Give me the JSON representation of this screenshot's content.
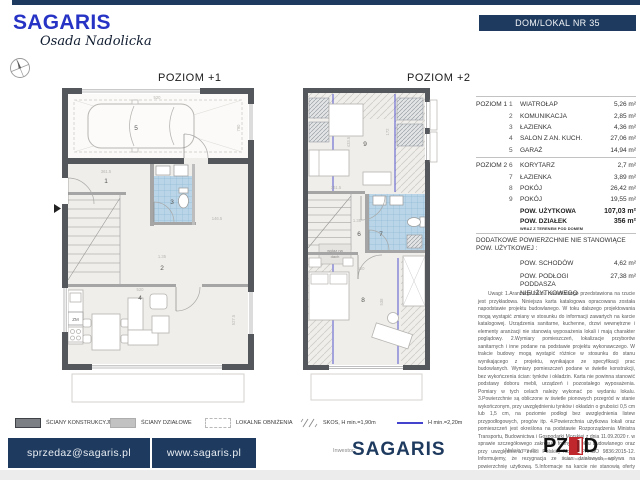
{
  "header": {
    "brand": "SAGARIS",
    "brand_sub": "Osada Nadolicka",
    "unit_label": "DOM/LOKAL NR 35"
  },
  "plans": {
    "level1": {
      "title": "POZIOM +1",
      "rooms": {
        "n1": "1",
        "n2": "2",
        "n3": "3",
        "n4": "4",
        "n5": "5"
      },
      "labels": {
        "dishwasher": "ZM"
      },
      "dims": {
        "garage_width": "520",
        "garage_depth": "790",
        "hall_width": "361.5",
        "corridor": "1.35",
        "niche": "146.5",
        "salon_width": "520",
        "salon_depth": "527.5"
      }
    },
    "level2": {
      "title": "POZIOM +2",
      "rooms": {
        "n6": "6",
        "n7": "7",
        "n8": "8",
        "n9": "9"
      },
      "labels": {
        "roof_hatch_line1": "wyłaz na",
        "roof_hatch_line2": "dach"
      },
      "dims": {
        "room9_depth": "433.5",
        "room9_width": "172",
        "hall_width": "361.5",
        "corridor": "1.35",
        "room8_width": "520",
        "room8_depth": "538"
      }
    }
  },
  "table": {
    "rows": [
      {
        "level": "POZIOM 1",
        "no": "1",
        "label": "WIATROŁAP",
        "area": "5,26 m²"
      },
      {
        "level": "",
        "no": "2",
        "label": "KOMUNIKACJA",
        "area": "2,85 m²"
      },
      {
        "level": "",
        "no": "3",
        "label": "ŁAZIENKA",
        "area": "4,36 m²"
      },
      {
        "level": "",
        "no": "4",
        "label": "SALON Z AN. KUCH.",
        "area": "27,06 m²"
      },
      {
        "level": "",
        "no": "5",
        "label": "GARAŻ",
        "area": "14,94 m²"
      },
      {
        "level": "POZIOM 2",
        "no": "6",
        "label": "KORYTARZ",
        "area": "2,7 m²"
      },
      {
        "level": "",
        "no": "7",
        "label": "ŁAZIENKA",
        "area": "3,89 m²"
      },
      {
        "level": "",
        "no": "8",
        "label": "POKÓJ",
        "area": "26,42 m²"
      },
      {
        "level": "",
        "no": "9",
        "label": "POKÓJ",
        "area": "19,55 m²"
      }
    ],
    "totals": [
      {
        "label": "POW. UŻYTKOWA",
        "sub": "",
        "value": "107,03 m²"
      },
      {
        "label": "POW. DZIAŁEK",
        "sub": "WRAZ Z TERENEM POD DOMEM",
        "value": "356 m²"
      }
    ],
    "additional_title": "DODATKOWE POWIERZCHNIE NIE STANOWIĄCE POW. UŻYTKOWEJ :",
    "additional": [
      {
        "label": "POW. SCHODÓW",
        "value": "4,62 m²"
      },
      {
        "label": "POW. PODŁOGI PODDASZA NIEUŻYTKOWEGO",
        "value": "27,38 m²"
      }
    ]
  },
  "notes": {
    "text": "Uwagi: 1.Aranżacja lokalu mieszkalnego przedstawiona na rzucie jest przykładowa. Niniejsza karta katalogowa opracowana została napodstawie projektu budowlanego. W toku dalszego projektowania mogą wystąpić zmiany w stosunku do informacji zawartych na karcie katalogowej. Urządzenia sanitarne, kuchenne, drzwi wewnętrzne i elementy aranżacji nie stanowią wyposażenia lokali i mają charakter poglądowy. 2.Wymiary pomieszczeń, lokalizacje przyborów sanitarnych i inne podane na podstawie projektu wykonawczego. W trakcie budowy mogą wystąpić różnice w stosunku do stanu wynikającego z projektu, wynikające ze specyfikacji prac budowlanych. Wymiary pomieszczeń podane w świetle konstrukcji, bez wykończenia ścian: tynków i okładzin. Karta nie powinna stanowić podstawy doboru mebli, urządzeń i pozostałego wyposażenia. Pomiary w tych celach należy wykonać po wydaniu lokalu. 3.Powierzchnie są obliczone w świetle pionowych przegród w stanie wykończonym, przy uwzględnieniu tynków i okładzin o grubości 0,5 cm lub 1,5 cm, na poziomie podłogi bez uwzględnienia listew przypodłogowych, progów itp. 4.Powierzchnia użytkowa lokali oraz pomieszczeń jest określona na podstawie Rozporządzenia Ministra Transportu, Budownictwa i Gospodarki Morskiej z dnia 11.09.2020 r. w sprawie szczegółowego zakresu i formy projektu budowlanego oraz przy uwzględnieniu treści Polskiej Normy PN-ISO 9836:2015-12. Informujemy, że rezygnacja ze ścian działowych wpływa na powierzchnię użytkową. 5.Informacje na karcie nie stanowią oferty handlowej w rozumieniu art. 66 kodeksu cywilnego"
  },
  "legend": {
    "items": [
      {
        "label": "ŚCIANY KONSTRUKCYJNE"
      },
      {
        "label": "ŚCIANY DZIAŁOWE"
      },
      {
        "label": "LOKALNE OBNIŻENIA"
      },
      {
        "label": "SKOS, H min.=1,90m"
      },
      {
        "label": "H min.=2,20m"
      }
    ]
  },
  "footer": {
    "email": "sprzedaz@sagaris.pl",
    "website": "www.sagaris.pl",
    "investor_label": "Inwestor:",
    "investor_name": "SAGARIS",
    "member_label": "Należymy do:",
    "member_logo_left": "PZ",
    "member_logo_right": "D",
    "member_sub": "Polski Związek Firm Deweloperskich"
  },
  "colors": {
    "navy": "#1e3a5e",
    "brand_blue": "#2633c4",
    "wall_dark": "#54585c",
    "bath_tile": "#b9d5e7",
    "hmin_line": "#4343cd",
    "pzfd_red": "#c0272d"
  }
}
